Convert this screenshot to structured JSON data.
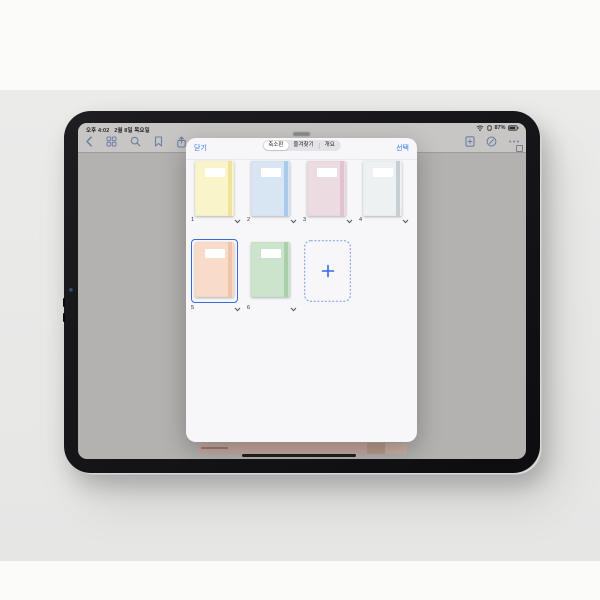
{
  "status_bar": {
    "time": "오후 4:02",
    "date": "2월 8일 목요일",
    "battery": "87%",
    "right_icons": [
      "wifi-icon",
      "connectivity-icon",
      "battery-icon"
    ]
  },
  "toolbar": {
    "left_icons": [
      "back-chevron-icon",
      "thumbnails-grid-icon",
      "search-icon",
      "bookmark-icon",
      "share-icon"
    ],
    "right_icons": [
      "add-page-icon",
      "pen-mode-icon",
      "more-ellipsis-icon"
    ]
  },
  "modal": {
    "close_label": "닫기",
    "select_label": "선택",
    "tabs": [
      {
        "label": "축소판",
        "selected": true
      },
      {
        "label": "즐겨찾기",
        "selected": false
      },
      {
        "label": "개요",
        "selected": false
      }
    ],
    "pages": [
      {
        "number": "1",
        "cover_color": "#faf4c9",
        "spine_color": "#ece09c",
        "selected": false
      },
      {
        "number": "2",
        "cover_color": "#d8e6f4",
        "spine_color": "#a6c8ea",
        "selected": false
      },
      {
        "number": "3",
        "cover_color": "#ecdbe0",
        "spine_color": "#dfc2cb",
        "selected": false
      },
      {
        "number": "4",
        "cover_color": "#eef1f2",
        "spine_color": "#c5ccd1",
        "selected": false
      },
      {
        "number": "5",
        "cover_color": "#f8dcc9",
        "spine_color": "#eec2a9",
        "selected": true
      },
      {
        "number": "6",
        "cover_color": "#cbe4cb",
        "spine_color": "#a7cfa8",
        "selected": false
      }
    ],
    "add_icon": "plus-icon"
  },
  "colors": {
    "accent_blue": "#3478f6",
    "selection_border": "#3a6bdc",
    "dimmed_toolbar_icon": "#6f7fa3",
    "sheet_background": "#f7f7f9",
    "screen_canvas": "#b4b2b1",
    "desk_strip": "#c9aba0"
  }
}
